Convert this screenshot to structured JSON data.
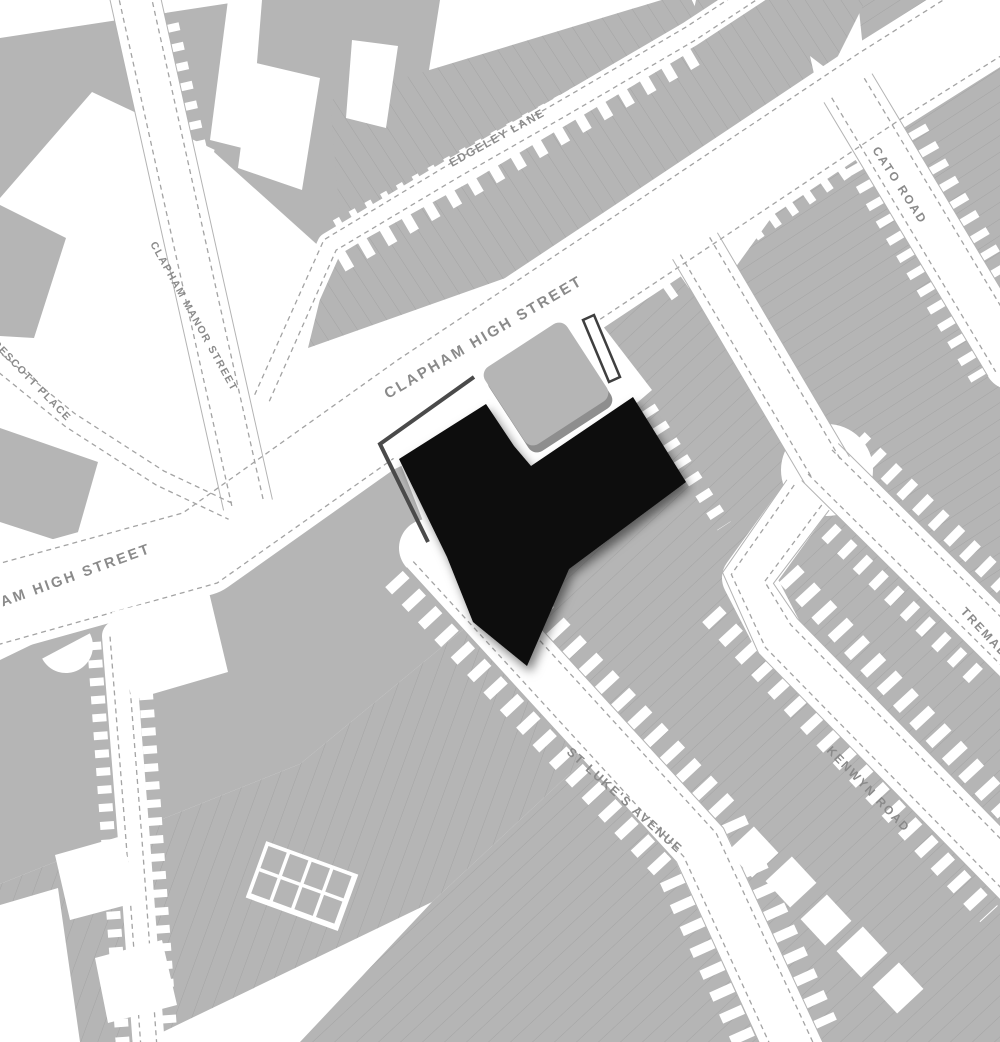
{
  "map": {
    "kind": "site-location-plan",
    "colors": {
      "bg": "#ffffff",
      "building": "#b5b5b5",
      "parcel_line": "#a2a2a2",
      "dash_line": "#a3a3a3",
      "curb_line": "#b3b3b3",
      "label": "#8a8a8a",
      "site_outline": "#4a4a4a",
      "building_shadow": "#8e8e8e",
      "footprint": "#080808",
      "strip_outline": "#3f3f3f"
    },
    "street_names": [
      "CLAPHAM HIGH STREET",
      "CLAPHAM MANOR STREET",
      "PRESCOTT  PLACE",
      "EDGELEY LANE",
      "CATO ROAD",
      "ST LUKE'S  AVENUE",
      "KENWYN ROAD",
      "TREMADOC ROAD"
    ],
    "labels": [
      {
        "id": "clapham-high-street",
        "text": "CLAPHAM HIGH STREET",
        "x": 388,
        "y": 399,
        "rot": -30.5,
        "size": 15,
        "ls": 2.5
      },
      {
        "id": "clapham-high-street-west",
        "text": "CLAPHAM HIGH STREET",
        "x": -56,
        "y": 628,
        "rot": -20,
        "size": 14.5,
        "ls": 2.5
      },
      {
        "id": "edgeley-lane",
        "text": "EDGELEY LANE",
        "x": 452,
        "y": 167,
        "rot": -29,
        "size": 11.5,
        "ls": 1.5
      },
      {
        "id": "clapham-manor-street",
        "text": "CLAPHAM MANOR STREET",
        "x": 150,
        "y": 244,
        "rot": 61,
        "size": 10.5,
        "ls": 1.5
      },
      {
        "id": "prescott-place",
        "text": "PRESCOTT  PLACE",
        "x": -14,
        "y": 338,
        "rot": 46,
        "size": 10.5,
        "ls": 1.5
      },
      {
        "id": "cato-road",
        "text": "CATO ROAD",
        "x": 872,
        "y": 150,
        "rot": 57,
        "size": 12,
        "ls": 2
      },
      {
        "id": "st-lukes-avenue",
        "text": "ST LUKE'S  AVENUE",
        "x": 566,
        "y": 753,
        "rot": 42,
        "size": 12.5,
        "ls": 2
      },
      {
        "id": "kenwyn-road",
        "text": "KENWYN ROAD",
        "x": 826,
        "y": 751,
        "rot": 46,
        "size": 12,
        "ls": 2
      },
      {
        "id": "tremadoc-road",
        "text": "TREMADOC ROAD",
        "x": 960,
        "y": 612,
        "rot": 47,
        "size": 12,
        "ls": 2
      }
    ],
    "blocks": [
      {
        "id": "b-topleft",
        "pts": [
          [
            0,
            38
          ],
          [
            250,
            0
          ],
          [
            232,
            158
          ],
          [
            92,
            92
          ],
          [
            0,
            198
          ]
        ],
        "pat": ""
      },
      {
        "id": "b-top-mid",
        "pts": [
          [
            256,
            0
          ],
          [
            440,
            0
          ],
          [
            412,
            178
          ],
          [
            332,
            258
          ],
          [
            214,
            152
          ]
        ],
        "pat": ""
      },
      {
        "id": "b-edgeley-north",
        "pts": [
          [
            330,
            100
          ],
          [
            688,
            -8
          ],
          [
            706,
            30
          ],
          [
            342,
            242
          ]
        ],
        "pat": "A"
      },
      {
        "id": "b-edgeley-chs-terrace",
        "pts": [
          [
            308,
            348
          ],
          [
            330,
            258
          ],
          [
            470,
            182
          ],
          [
            700,
            46
          ],
          [
            778,
            26
          ],
          [
            652,
            226
          ]
        ],
        "pat": "A"
      },
      {
        "id": "b-left-edge-1",
        "pts": [
          [
            0,
            205
          ],
          [
            66,
            238
          ],
          [
            34,
            338
          ],
          [
            0,
            336
          ]
        ],
        "pat": ""
      },
      {
        "id": "b-left-edge-2",
        "pts": [
          [
            0,
            428
          ],
          [
            98,
            462
          ],
          [
            74,
            546
          ],
          [
            0,
            522
          ]
        ],
        "pat": ""
      },
      {
        "id": "b-sw-chs",
        "pts": [
          [
            0,
            660
          ],
          [
            430,
            452
          ],
          [
            545,
            562
          ],
          [
            300,
            764
          ],
          [
            0,
            884
          ]
        ],
        "pat": ""
      },
      {
        "id": "b-bottom-left",
        "pts": [
          [
            0,
            884
          ],
          [
            300,
            764
          ],
          [
            545,
            562
          ],
          [
            668,
            682
          ],
          [
            432,
            902
          ],
          [
            142,
            1042
          ],
          [
            0,
            1042
          ]
        ],
        "pat": "E"
      },
      {
        "id": "b-bottom-mid",
        "pts": [
          [
            432,
            902
          ],
          [
            668,
            682
          ],
          [
            790,
            800
          ],
          [
            768,
            1042
          ],
          [
            300,
            1042
          ]
        ],
        "pat": "B"
      },
      {
        "id": "b-east-of-site",
        "pts": [
          [
            478,
            382
          ],
          [
            692,
            256
          ],
          [
            820,
            466
          ],
          [
            1000,
            645
          ],
          [
            1000,
            1042
          ],
          [
            778,
            1042
          ],
          [
            430,
            548
          ]
        ],
        "pat": "B"
      },
      {
        "id": "b-cato-tremadoc",
        "pts": [
          [
            735,
            268
          ],
          [
            852,
            106
          ],
          [
            1012,
            356
          ],
          [
            1012,
            648
          ],
          [
            830,
            462
          ]
        ],
        "pat": "C"
      },
      {
        "id": "b-topright",
        "pts": [
          [
            858,
            0
          ],
          [
            1002,
            0
          ],
          [
            1002,
            352
          ],
          [
            870,
            118
          ]
        ],
        "pat": "C"
      },
      {
        "id": "b-top-band",
        "pts": [
          [
            696,
            0
          ],
          [
            866,
            0
          ],
          [
            802,
            128
          ],
          [
            700,
            252
          ],
          [
            646,
            232
          ]
        ],
        "pat": "A"
      }
    ],
    "tooth_lines": [
      {
        "pts": [
          [
            340,
            262
          ],
          [
            700,
            52
          ]
        ],
        "w": 22,
        "dash": "10 15"
      },
      {
        "pts": [
          [
            336,
            226
          ],
          [
            690,
            30
          ]
        ],
        "w": 13,
        "dash": "7 11"
      },
      {
        "pts": [
          [
            456,
            521
          ],
          [
            731,
            816
          ],
          [
            825,
            1025
          ]
        ],
        "w": 26,
        "dash": "10 14"
      },
      {
        "pts": [
          [
            394,
            579
          ],
          [
            669,
            874
          ],
          [
            763,
            1083
          ]
        ],
        "w": 24,
        "dash": "10 14"
      },
      {
        "pts": [
          [
            772,
            556
          ],
          [
            1050,
            856
          ]
        ],
        "w": 26,
        "dash": "10 14"
      },
      {
        "pts": [
          [
            711,
            614
          ],
          [
            989,
            914
          ]
        ],
        "w": 24,
        "dash": "10 14"
      },
      {
        "pts": [
          [
            857,
            440
          ],
          [
            1045,
            625
          ]
        ],
        "w": 22,
        "dash": "9 13"
      },
      {
        "pts": [
          [
            797,
            500
          ],
          [
            985,
            685
          ]
        ],
        "w": 20,
        "dash": "9 13"
      },
      {
        "pts": [
          [
            886,
            77
          ],
          [
            946,
            182
          ],
          [
            1041,
            342
          ]
        ],
        "w": 22,
        "dash": "8 12"
      },
      {
        "pts": [
          [
            824,
            113
          ],
          [
            884,
            218
          ],
          [
            979,
            378
          ]
        ],
        "w": 18,
        "dash": "8 12"
      },
      {
        "pts": [
          [
            666,
            292
          ],
          [
            900,
            130
          ]
        ],
        "w": 20,
        "dash": "8 13"
      },
      {
        "pts": [
          [
            162,
            -15
          ],
          [
            229,
            283
          ],
          [
            277,
            498
          ]
        ],
        "w": 16,
        "dash": "8 12"
      },
      {
        "pts": [
          [
            142,
            638
          ],
          [
            172,
            1058
          ]
        ],
        "w": 14,
        "dash": "8 10"
      },
      {
        "pts": [
          [
            94,
            642
          ],
          [
            124,
            1062
          ]
        ],
        "w": 14,
        "dash": "8 10"
      },
      {
        "pts": [
          [
            648,
            408
          ],
          [
            724,
            526
          ]
        ],
        "w": 16,
        "dash": "8 12"
      }
    ],
    "streets": [
      {
        "id": "clapham-high-street",
        "pts": [
          [
            -30,
            612
          ],
          [
            200,
            548
          ],
          [
            420,
            392
          ],
          [
            640,
            246
          ],
          [
            880,
            86
          ],
          [
            1045,
            -18
          ]
        ],
        "w": 96,
        "dash_off": 39,
        "curb": false
      },
      {
        "id": "clapham-manor-street",
        "pts": [
          [
            133,
            -12
          ],
          [
            200,
            290
          ],
          [
            248,
            505
          ]
        ],
        "w": 50,
        "dash_off": 16,
        "curb": true
      },
      {
        "id": "prescott-place",
        "pts": [
          [
            -10,
            355
          ],
          [
            70,
            420
          ],
          [
            160,
            478
          ],
          [
            232,
            512
          ]
        ],
        "w": 34,
        "dash_off": 8,
        "curb": false
      },
      {
        "id": "edgeley-lane",
        "pts": [
          [
            262,
            398
          ],
          [
            330,
            245
          ],
          [
            455,
            170
          ],
          [
            560,
            110
          ],
          [
            690,
            34
          ],
          [
            760,
            -12
          ]
        ],
        "w": 26,
        "dash_off": 8,
        "curb": false
      },
      {
        "id": "cato-road",
        "pts": [
          [
            848,
            88
          ],
          [
            915,
            200
          ],
          [
            1012,
            362
          ]
        ],
        "w": 56,
        "dash_off": 19,
        "curb": true
      },
      {
        "id": "kenwyn-link",
        "pts": [
          [
            695,
            246
          ],
          [
            827,
            470
          ]
        ],
        "w": 52,
        "dash_off": 17,
        "curb": true
      },
      {
        "id": "tremadoc-road",
        "pts": [
          [
            820,
            462
          ],
          [
            1018,
            658
          ]
        ],
        "w": 52,
        "dash_off": 17,
        "curb": true
      },
      {
        "id": "kenwyn-road",
        "pts": [
          [
            808,
            495
          ],
          [
            748,
            578
          ],
          [
            778,
            636
          ],
          [
            1025,
            888
          ]
        ],
        "w": 52,
        "dash_off": 17,
        "curb": true
      },
      {
        "id": "st-lukes-avenue",
        "pts": [
          [
            428,
            548
          ],
          [
            700,
            845
          ],
          [
            800,
            1062
          ]
        ],
        "w": 58,
        "dash_off": 20,
        "curb": true
      },
      {
        "id": "back-lane",
        "pts": [
          [
            118,
            636
          ],
          [
            134,
            840
          ],
          [
            150,
            1062
          ]
        ],
        "w": 32,
        "dash_off": 8,
        "curb": false
      }
    ],
    "junction_patches": [
      {
        "type": "poly",
        "pts": [
          [
            160,
            470
          ],
          [
            330,
            400
          ],
          [
            382,
            472
          ],
          [
            240,
            566
          ]
        ]
      },
      {
        "type": "poly",
        "pts": [
          [
            396,
            452
          ],
          [
            470,
            412
          ],
          [
            540,
            522
          ],
          [
            446,
            580
          ]
        ]
      },
      {
        "type": "circle",
        "cx": 827,
        "cy": 470,
        "r": 46
      },
      {
        "type": "poly",
        "pts": [
          [
            810,
            56
          ],
          [
            904,
            128
          ],
          [
            836,
            172
          ]
        ]
      }
    ],
    "white_patches": [
      {
        "type": "poly",
        "pts": [
          [
            252,
            62
          ],
          [
            320,
            78
          ],
          [
            302,
            190
          ],
          [
            238,
            168
          ]
        ]
      },
      {
        "type": "poly",
        "pts": [
          [
            352,
            40
          ],
          [
            398,
            46
          ],
          [
            386,
            128
          ],
          [
            346,
            118
          ]
        ]
      },
      {
        "type": "poly",
        "pts": [
          [
            228,
            0
          ],
          [
            262,
            0
          ],
          [
            250,
            150
          ],
          [
            210,
            140
          ]
        ]
      },
      {
        "type": "poly",
        "pts": [
          [
            112,
            612
          ],
          [
            208,
            588
          ],
          [
            228,
            672
          ],
          [
            132,
            700
          ]
        ]
      },
      {
        "type": "poly",
        "pts": [
          [
            55,
            855
          ],
          [
            122,
            836
          ],
          [
            138,
            902
          ],
          [
            70,
            920
          ]
        ]
      },
      {
        "type": "poly",
        "pts": [
          [
            95,
            958
          ],
          [
            162,
            940
          ],
          [
            177,
            1005
          ],
          [
            108,
            1023
          ]
        ]
      },
      {
        "type": "poly",
        "pts": [
          [
            0,
            905
          ],
          [
            58,
            888
          ],
          [
            80,
            1042
          ],
          [
            0,
            1042
          ]
        ]
      },
      {
        "type": "rect",
        "x": 735,
        "y": 834,
        "w": 36,
        "h": 36,
        "rot": 47
      },
      {
        "type": "rect",
        "x": 773,
        "y": 864,
        "w": 36,
        "h": 36,
        "rot": 47
      },
      {
        "type": "rect",
        "x": 808,
        "y": 902,
        "w": 36,
        "h": 36,
        "rot": 47
      },
      {
        "type": "rect",
        "x": 844,
        "y": 934,
        "w": 36,
        "h": 36,
        "rot": 47
      },
      {
        "type": "rect",
        "x": 880,
        "y": 970,
        "w": 36,
        "h": 36,
        "rot": 47
      },
      {
        "type": "semicircle",
        "cx": 66,
        "cy": 646,
        "r": 27,
        "rot": -28
      },
      {
        "type": "grid",
        "x": 268,
        "y": 845,
        "cols": 4,
        "rows": 2,
        "cw": 23,
        "ch": 27,
        "rot": 20
      }
    ],
    "site": {
      "forecourt": [
        [
          376,
          444
        ],
        [
          472,
          374
        ],
        [
          592,
          312
        ],
        [
          652,
          390
        ],
        [
          638,
          402
        ],
        [
          530,
          470
        ],
        [
          398,
          462
        ]
      ],
      "boundary": [
        [
          474,
          377
        ],
        [
          380,
          444
        ],
        [
          428,
          542
        ]
      ],
      "existing_building": {
        "cx": 546,
        "cy": 384,
        "w": 98,
        "h": 92,
        "rot": -33,
        "rx": 10,
        "shadow_dx": 4,
        "shadow_dy": 7
      },
      "outbuilding_strip": [
        [
          583,
          320
        ],
        [
          594,
          315
        ],
        [
          620,
          377
        ],
        [
          609,
          382
        ]
      ],
      "footprint": [
        [
          486,
          404
        ],
        [
          514,
          446
        ],
        [
          531,
          466
        ],
        [
          633,
          397
        ],
        [
          686,
          482
        ],
        [
          569,
          569
        ],
        [
          527,
          666
        ],
        [
          473,
          622
        ],
        [
          447,
          557
        ],
        [
          399,
          459
        ]
      ]
    }
  }
}
